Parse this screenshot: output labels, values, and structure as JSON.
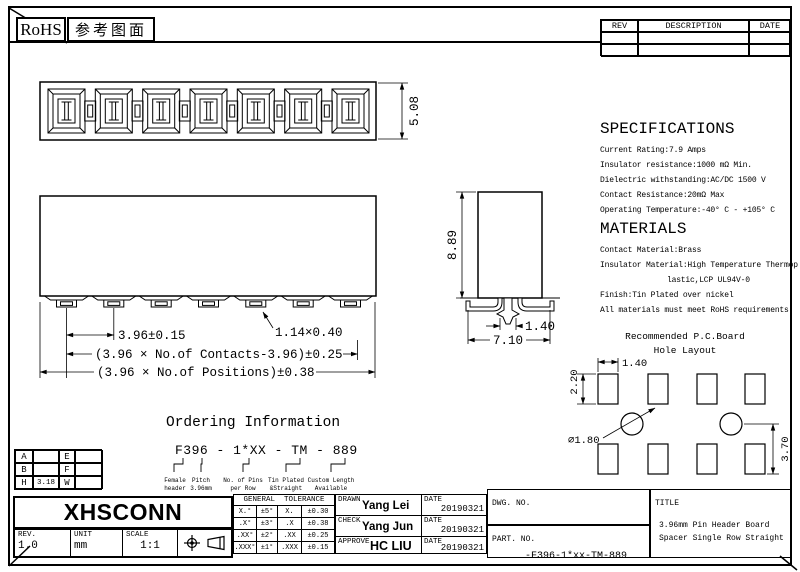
{
  "sheet": {
    "rohs_label": "RoHS",
    "reference_label": "参考图面"
  },
  "rev_table": {
    "headers": [
      "REV",
      "DESCRIPTION",
      "DATE"
    ]
  },
  "drawing_dims": {
    "top_height": "5.08",
    "pitch": "3.96±0.15",
    "pin_cross_section": "1.14×0.40",
    "contacts_span": "(3.96 × No.of Contacts-3.96)±0.25",
    "positions_span": "(3.96 × No.of Positions)±0.38",
    "body_height": "8.89",
    "peg_width": "1.40",
    "body_depth": "7.10"
  },
  "specifications": {
    "title": "SPECIFICATIONS",
    "items": [
      "Current Rating:7.9 Amps",
      "Insulator resistance:1000 mΩ Min.",
      "Dielectric withstanding:AC/DC 1500 V",
      "Contact Resistance:20mΩ Max",
      "Operating Temperature:-40° C - +105° C"
    ]
  },
  "materials": {
    "title": "MATERIALS",
    "items": [
      "Contact Material:Brass",
      "Insulator Material:High Temperature Thermop",
      "lastic,LCP UL94V-0",
      "Finish:Tin Plated over nickel",
      "All materials must meet RoHS requirements"
    ]
  },
  "pcb_layout": {
    "title_line1": "Recommended P.C.Board",
    "title_line2": "Hole Layout",
    "hole_width": "1.40",
    "hole_height": "2.20",
    "hole_diameter": "∅1.80",
    "row_spacing": "3.70"
  },
  "ordering": {
    "title": "Ordering Information",
    "part_format": "F396 - 1*XX - TM - 889",
    "legend": [
      [
        "Female",
        "header"
      ],
      [
        "Pitch",
        "3.96mm"
      ],
      [
        "No. of Pins",
        "per Row"
      ],
      [
        "Tin Plated",
        "&Straight"
      ],
      [
        "Custom Length",
        "Available"
      ]
    ]
  },
  "dim_table": {
    "rows": [
      [
        "A",
        "",
        "E",
        ""
      ],
      [
        "B",
        "",
        "F",
        ""
      ],
      [
        "H",
        "3.18",
        "W",
        ""
      ]
    ]
  },
  "title_block": {
    "company": "XHSCONN",
    "rev_label": "REV.",
    "rev_value": "1.0",
    "unit_label": "UNIT",
    "unit_value": "mm",
    "scale_label": "SCALE",
    "scale_value": "1:1",
    "date_label": "DATE",
    "tolerance": {
      "header": "GENERAL  TOLERANCE",
      "rows": [
        [
          "X.°",
          "±5°",
          "X.",
          "±0.30"
        ],
        [
          ".X°",
          "±3°",
          ".X",
          "±0.38"
        ],
        [
          ".XX°",
          "±2°",
          ".XX",
          "±0.25"
        ],
        [
          ".XXX°",
          "±1°",
          ".XXX",
          "±0.15"
        ]
      ]
    },
    "signoff": [
      {
        "role": "DRAWN",
        "name": "Yang Lei",
        "date": "20190321"
      },
      {
        "role": "CHECK",
        "name": "Yang Jun",
        "date": "20190321"
      },
      {
        "role": "APPROVE",
        "name": "HC LIU",
        "date": "20190321"
      }
    ],
    "dwg_no_label": "DWG. NO.",
    "part_no_label": "PART. NO.",
    "part_no": "-F396-1*xx-TM-889",
    "title_label": "TITLE",
    "title_line1": "3.96mm Pin Header Board",
    "title_line2": "Spacer Single Row Straight"
  }
}
